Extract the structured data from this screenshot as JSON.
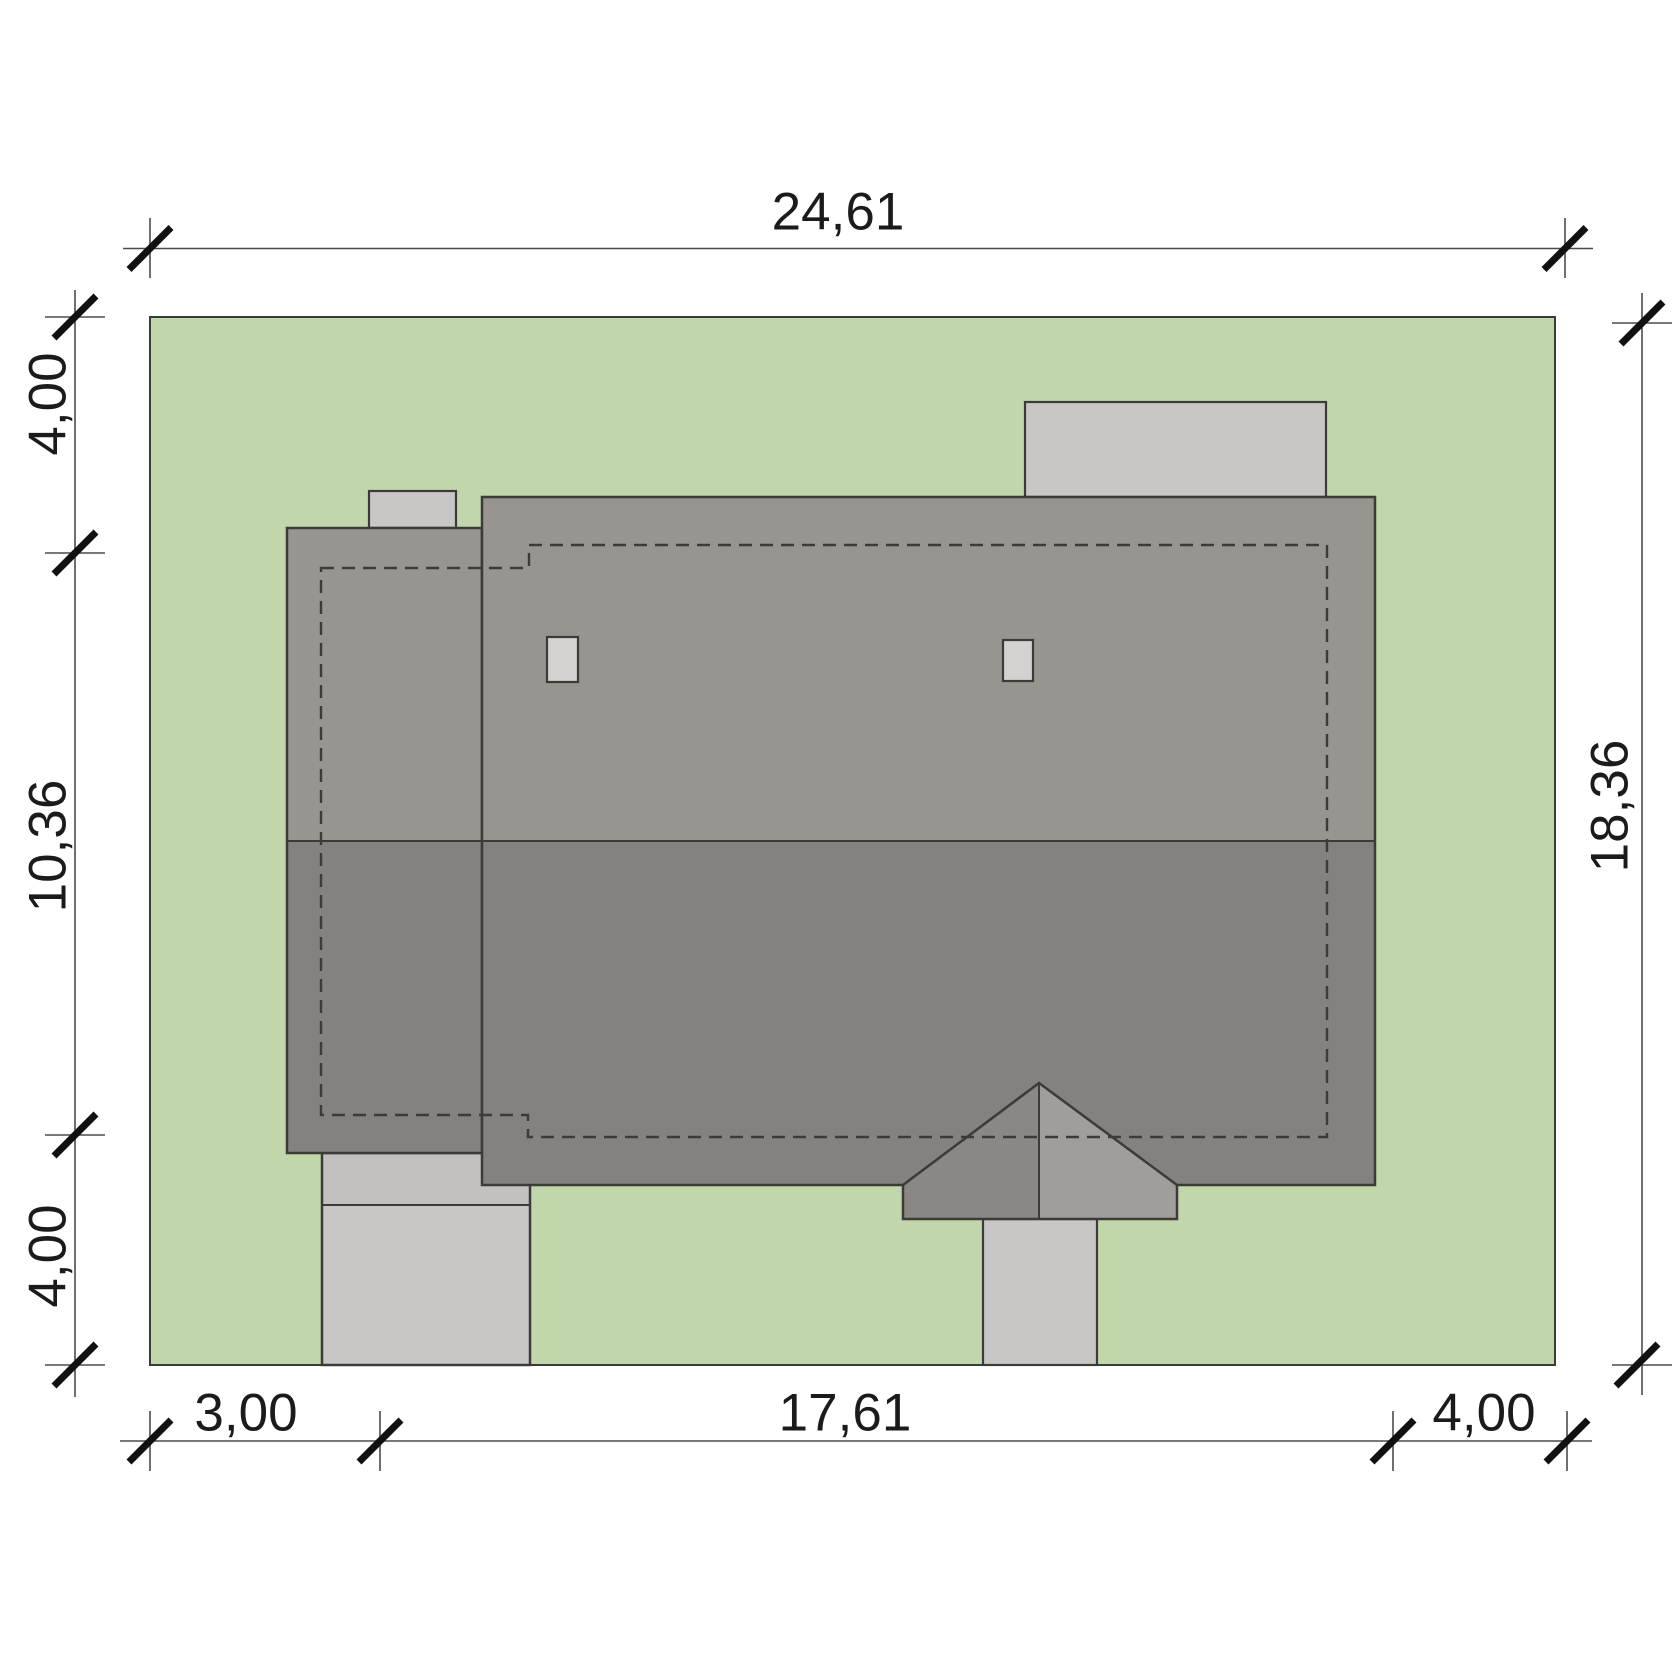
{
  "dimensions": {
    "top_width": "24,61",
    "right_height": "18,36",
    "left_top": "4,00",
    "left_middle": "10,36",
    "left_bottom": "4,00",
    "bottom_left": "3,00",
    "bottom_middle": "17,61",
    "bottom_right": "4,00"
  },
  "colors": {
    "background": "#ffffff",
    "plot_green": "#c1d6aa",
    "roof_upper": "#98948f",
    "roof_lower": "#85817e",
    "porch_left": "#8b8784",
    "porch_right": "#a19d9a",
    "paving": "#c8c7c5",
    "paving_dark": "#c2c1bf",
    "paving_light": "#d3d2d0",
    "outline": "#3b3b39",
    "dim_line": "#4b4b4b",
    "tick": "#111111",
    "dim_text": "#1b1b1b"
  }
}
